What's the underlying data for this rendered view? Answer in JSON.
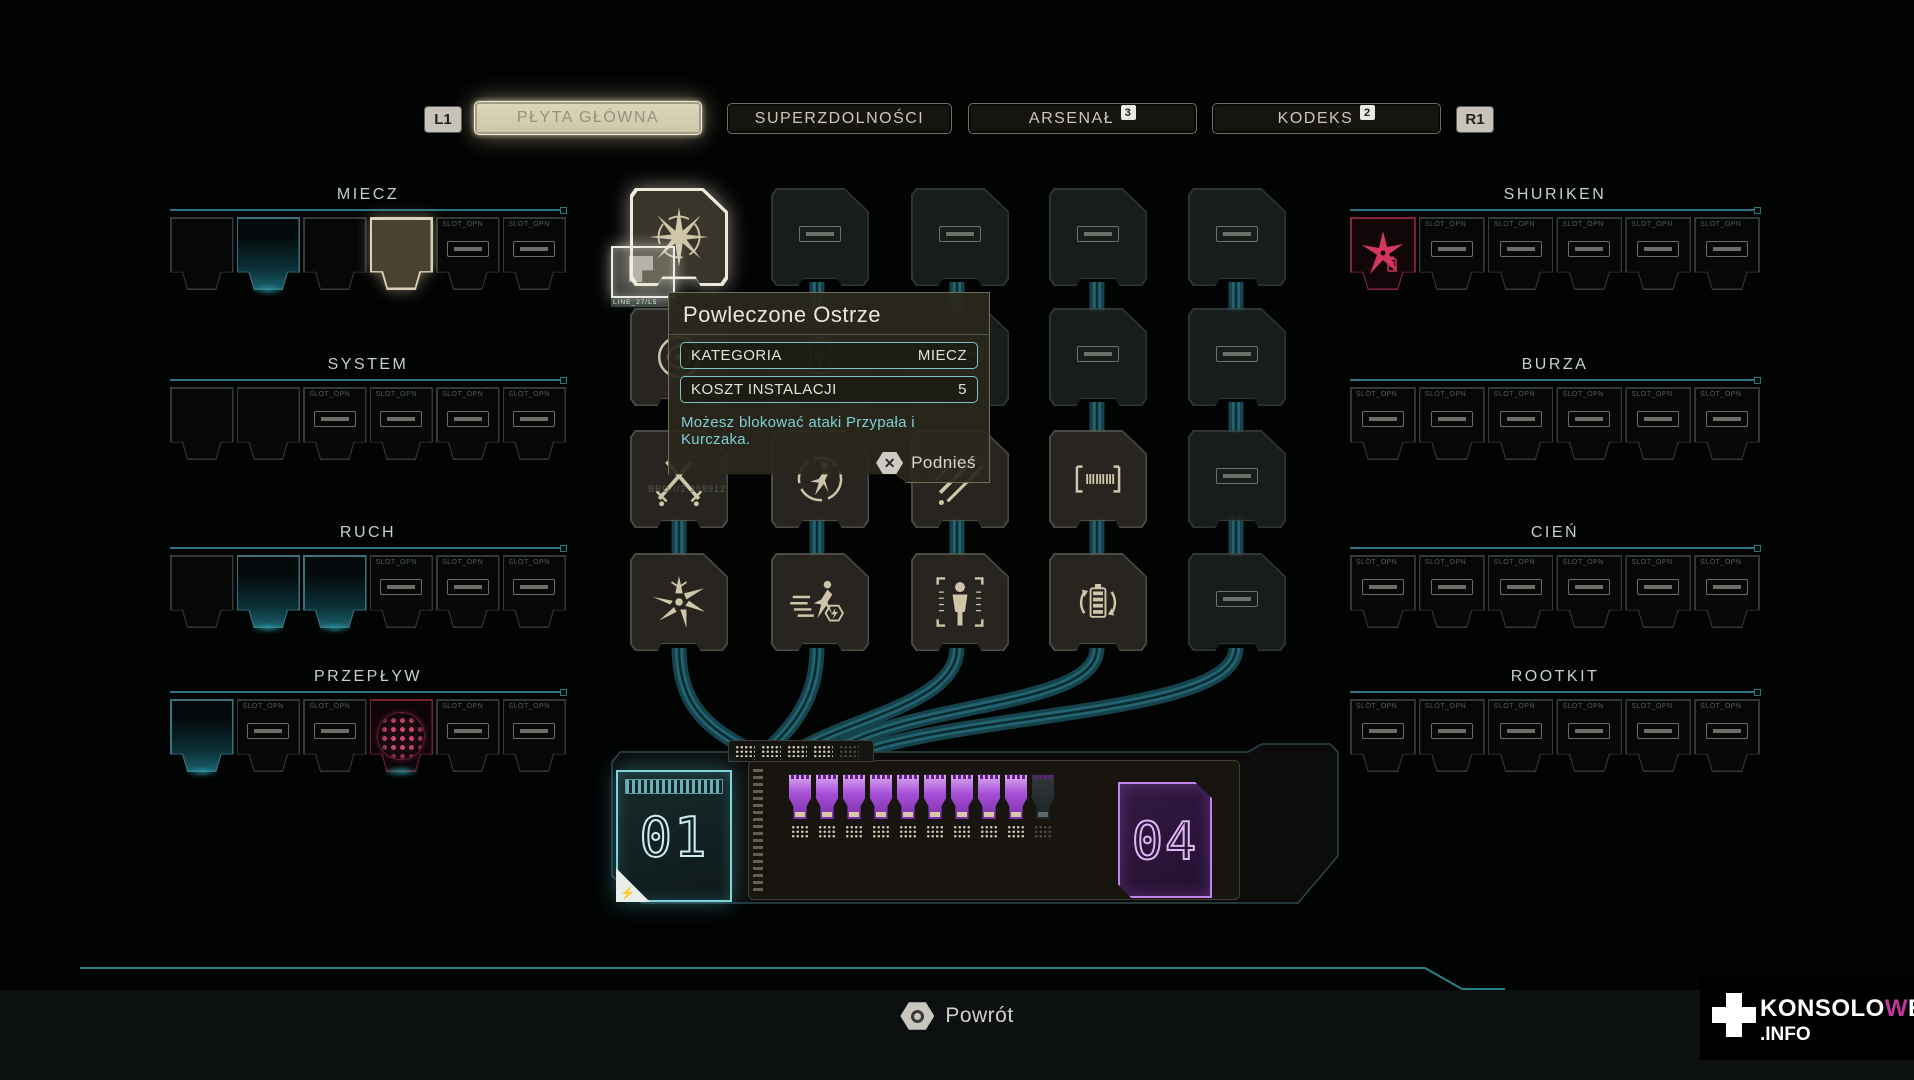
{
  "header": {
    "shoulder_left": "L1",
    "shoulder_right": "R1",
    "tabs": [
      {
        "slug": "plyta-glowna",
        "label": "PŁYTA GŁÓWNA",
        "active": true
      },
      {
        "slug": "superzdolnosci",
        "label": "SUPERZDOLNOŚCI",
        "active": false
      },
      {
        "slug": "arsenal",
        "label": "ARSENAŁ",
        "active": false,
        "badge": "3"
      },
      {
        "slug": "kodeks",
        "label": "KODEKS",
        "active": false,
        "badge": "2"
      }
    ]
  },
  "slot_open_label": "SLOT_OPN",
  "left_groups": [
    {
      "slug": "miecz",
      "title": "MIECZ",
      "slots": [
        "empty",
        "glow",
        "empty",
        "selected",
        "open",
        "open"
      ]
    },
    {
      "slug": "system",
      "title": "SYSTEM",
      "slots": [
        "empty",
        "empty",
        "open",
        "open",
        "open",
        "open"
      ]
    },
    {
      "slug": "ruch",
      "title": "RUCH",
      "slots": [
        "empty",
        "glow",
        "glow",
        "open",
        "open",
        "open"
      ]
    },
    {
      "slug": "przeplyw",
      "title": "PRZEPŁYW",
      "slots": [
        "glow",
        "open",
        "open",
        "core",
        "open",
        "open"
      ]
    }
  ],
  "right_groups": [
    {
      "slug": "shuriken",
      "title": "SHURIKEN",
      "slots": [
        "shuriken",
        "open",
        "open",
        "open",
        "open",
        "open"
      ]
    },
    {
      "slug": "burza",
      "title": "BURZA",
      "slots": [
        "open",
        "open",
        "open",
        "open",
        "open",
        "open"
      ]
    },
    {
      "slug": "cien",
      "title": "CIEŃ",
      "slots": [
        "open",
        "open",
        "open",
        "open",
        "open",
        "open"
      ]
    },
    {
      "slug": "rootkit",
      "title": "ROOTKIT",
      "slots": [
        "open",
        "open",
        "open",
        "open",
        "open",
        "open"
      ]
    }
  ],
  "grid": {
    "rows": [
      [
        {
          "type": "selected",
          "icon": "star"
        },
        {
          "type": "outline",
          "icon": "bar"
        },
        {
          "type": "outline",
          "icon": "bar"
        },
        {
          "type": "outline",
          "icon": "bar"
        },
        {
          "type": "outline",
          "icon": "bar"
        }
      ],
      [
        {
          "type": "chip",
          "icon": "rings"
        },
        {
          "type": "faint",
          "icon": "spark"
        },
        {
          "type": "outline",
          "icon": "bar"
        },
        {
          "type": "outline",
          "icon": "bar"
        },
        {
          "type": "outline",
          "icon": "bar"
        }
      ],
      [
        {
          "type": "chip",
          "icon": "swords"
        },
        {
          "type": "chip",
          "icon": "runner"
        },
        {
          "type": "chip",
          "icon": "slash"
        },
        {
          "type": "chip",
          "icon": "memory"
        },
        {
          "type": "outline",
          "icon": "bar"
        }
      ],
      [
        {
          "type": "chip",
          "icon": "burst"
        },
        {
          "type": "chip",
          "icon": "dash"
        },
        {
          "type": "chip",
          "icon": "person"
        },
        {
          "type": "chip",
          "icon": "battery"
        },
        {
          "type": "outline",
          "icon": "bar"
        }
      ]
    ]
  },
  "held_chip": {
    "micro_label": "LINE_27/L5"
  },
  "micro_serial": "BRD://2.298912",
  "tooltip": {
    "title": "Powleczone Ostrze",
    "rows": [
      {
        "label": "KATEGORIA",
        "value": "MIECZ"
      },
      {
        "label": "KOSZT INSTALACJI",
        "value": "5"
      }
    ],
    "description": "Możesz blokować ataki Przypała i Kurczaka.",
    "action": {
      "icon": "cross-button",
      "label": "Podnieś"
    }
  },
  "board": {
    "left_module_number": "01",
    "right_module_number": "04",
    "plugs_filled": 9,
    "plugs_empty": 1,
    "pin_blocks_lit": 4,
    "pin_blocks_dim": 1
  },
  "footer": {
    "back_label": "Powrót"
  },
  "watermark": {
    "pre": "KONSOLO",
    "accent": "W",
    "post": "E",
    "suffix": ".INFO"
  },
  "colors": {
    "accent_teal": "#2e8b96",
    "accent_purple": "#a64fd8",
    "accent_pink": "#d3375e",
    "active_tab": "#d5ceb2"
  }
}
